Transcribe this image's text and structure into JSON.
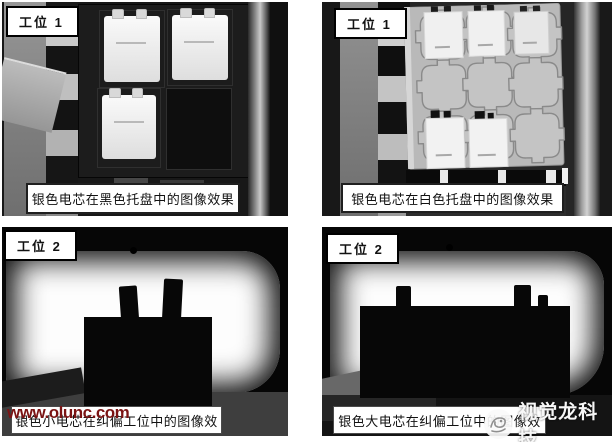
{
  "page": {
    "background": "#ffffff"
  },
  "panels": [
    {
      "name": "silver-cells-black-tray",
      "station": "工位 1",
      "caption": "银色电芯在黑色托盘中的图像效果"
    },
    {
      "name": "silver-cells-white-tray",
      "station": "工位 1",
      "caption": "银色电芯在白色托盘中的图像效果"
    },
    {
      "name": "small-cell-align-station",
      "station": "工位 2",
      "caption": "银色小电芯在纠偏工位中的图像效"
    },
    {
      "name": "large-cell-align-station",
      "station": "工位 2",
      "caption": "银色大电芯在纠偏工位中的图像效"
    }
  ],
  "watermarks": {
    "site_url": "www.olunc.com",
    "site_url_color": "#7b1414",
    "brand_name": "视觉龙科技",
    "brand_color": "#f7f7f7",
    "logo_icon": "dragon-circle-logo"
  },
  "colors": {
    "caption_bg": "#ffffff",
    "caption_border_top_row": "#1f1f1f",
    "caption_border_bottom_row": "#4a4a4a",
    "badge_bg": "#ffffff",
    "badge_border": "#000000",
    "photo_black": "#060606",
    "backlight_white": "#fdfdfd",
    "black_tray": "#1c1c1c",
    "white_tray": "#b9b9b9",
    "cell_white": "#f0f0f0"
  }
}
